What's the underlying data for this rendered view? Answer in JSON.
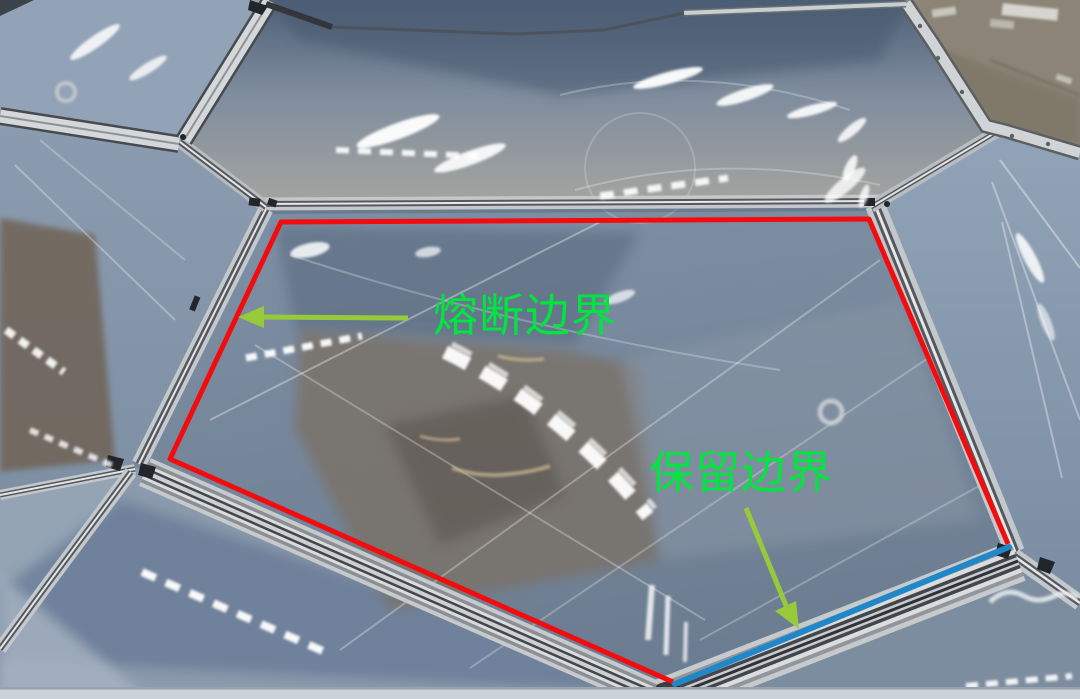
{
  "annotations": {
    "fuse_boundary": {
      "label": "熔断边界",
      "line_color": "#f40b0d"
    },
    "keep_boundary": {
      "label": "保留边界",
      "line_color": "#2087c9"
    },
    "label_color": "#00e63e",
    "arrow_color": "#96ca3b"
  }
}
